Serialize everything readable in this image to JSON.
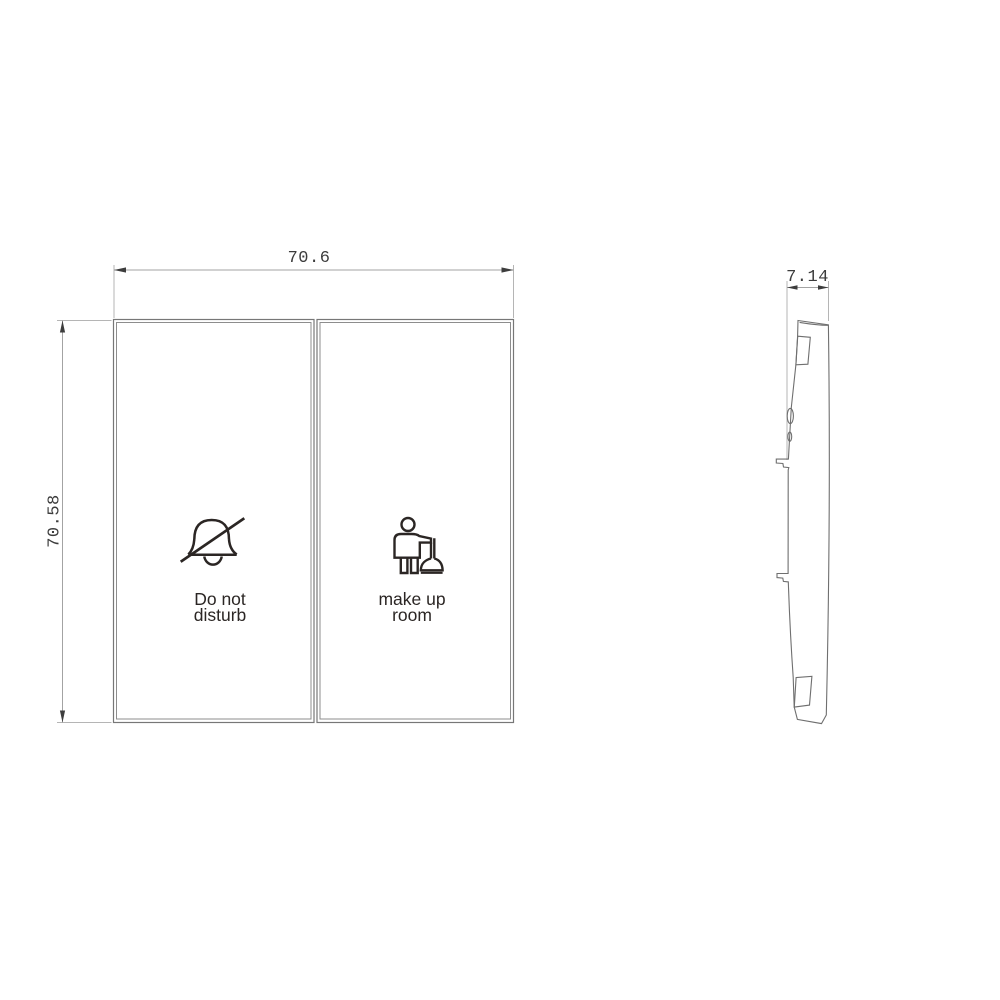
{
  "drawing": {
    "front_view": {
      "width_dim_label": "70.6",
      "height_dim_label": "70.58",
      "buttons": [
        {
          "id": "do-not-disturb",
          "icon": "no-bell-icon",
          "label_line1": "Do not",
          "label_line2": "disturb"
        },
        {
          "id": "make-up-room",
          "icon": "housekeeping-icon",
          "label_line1": "make up",
          "label_line2": "room"
        }
      ]
    },
    "side_view": {
      "depth_dim_label": "7.14"
    },
    "colors": {
      "background": "#ffffff",
      "panel_outline": "#777777",
      "dimension_line": "#a3a3a3",
      "extension_line": "#b5b5b5",
      "dimension_text": "#3c3c3c",
      "icon_ink": "#2b2624"
    }
  }
}
